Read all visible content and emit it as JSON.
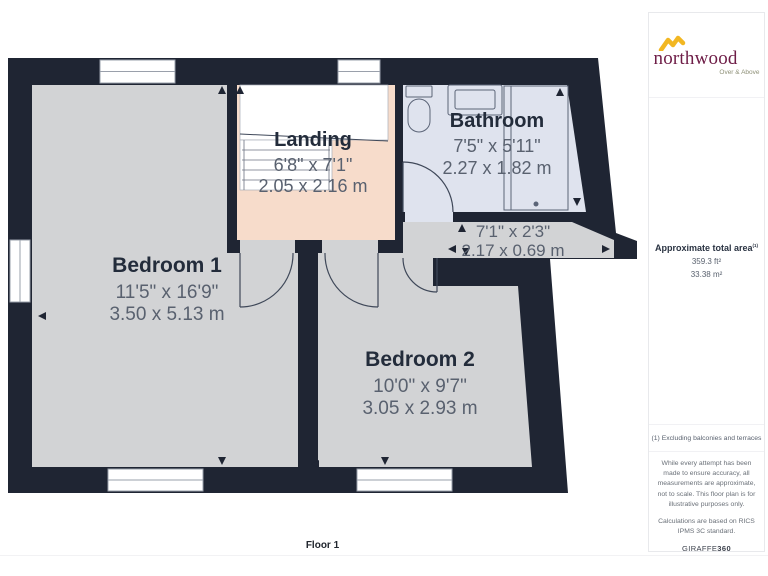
{
  "branding": {
    "name": "northwood",
    "tagline": "Over & Above"
  },
  "area_summary": {
    "label": "Approximate total area",
    "footnote_marker": "(1)",
    "imperial": "359.3 ft²",
    "metric": "33.38 m²"
  },
  "footnote": "(1) Excluding balconies and terraces",
  "disclaimer": "While every attempt has been made to ensure accuracy, all measurements are approximate, not to scale. This floor plan is for illustrative purposes only.",
  "standards": "Calculations are based on RICS IPMS 3C standard.",
  "provider": {
    "name": "GIRAFFE",
    "suffix": "360"
  },
  "floor_label": "Floor 1",
  "rooms": [
    {
      "name": "Bedroom 1",
      "imperial": "11'5\" x 16'9\"",
      "metric": "3.50 x 5.13 m"
    },
    {
      "name": "Bedroom 2",
      "imperial": "10'0\" x 9'7\"",
      "metric": "3.05 x 2.93 m"
    },
    {
      "name": "Landing",
      "imperial": "6'8\" x 7'1\"",
      "metric": "2.05 x 2.16 m"
    },
    {
      "name": "Bathroom",
      "imperial": "7'5\" x 5'11\"",
      "metric": "2.27 x 1.82 m"
    },
    {
      "imperial": "7'1\" x 2'3\"",
      "metric": "2.17 x 0.69 m"
    }
  ],
  "colors": {
    "walls": "#1F2533",
    "room_fill": "#D2D3D5",
    "landing_fill": "#F7DCCB",
    "bathroom_fill": "#DFE3EE",
    "brand_maroon": "#6E1D47",
    "brand_gold": "#F2B722"
  }
}
